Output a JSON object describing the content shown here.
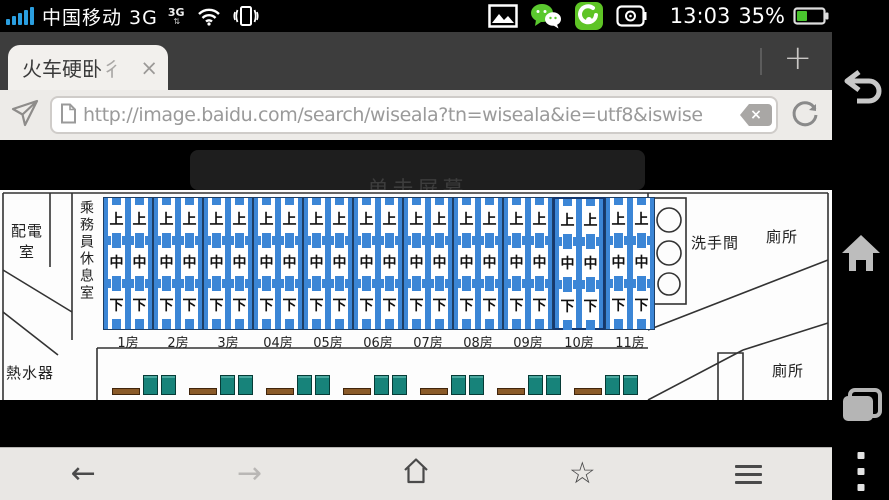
{
  "status_bar": {
    "carrier": "中国移动 3G",
    "network_badge": "3G",
    "network_arrows": "⇅",
    "time": "13:03",
    "battery_percent": "35%",
    "battery_level": 35
  },
  "tab_bar": {
    "tab_title": "火车硬卧",
    "tab_title_clipped": "彳",
    "tab_close": "×",
    "new_tab": "+"
  },
  "url_bar": {
    "url": "http://image.baidu.com/search/wiseala?tn=wiseala&ie=utf8&iswise",
    "clear_label": "×"
  },
  "content": {
    "hint_text": "单击屏幕",
    "diagram": {
      "power_room": "配電室",
      "crew_room": "乘務員休息室",
      "water_heater": "熱水器",
      "washroom": "洗手間",
      "toilet_upper": "廁所",
      "toilet_lower": "廁所",
      "berth_labels": [
        "上",
        "中",
        "下"
      ],
      "compartments": [
        "1房",
        "2房",
        "3房",
        "04房",
        "05房",
        "06房",
        "07房",
        "08房",
        "09房",
        "10房",
        "11房"
      ],
      "highlighted_compartment": "10房",
      "seat_groups": 7,
      "colors": {
        "berth_blue": "#3c86d6",
        "seat_teal": "#17837a",
        "table_brown": "#8a5a28"
      }
    }
  },
  "toolbar": {
    "back": "←",
    "forward": "→",
    "star": "☆"
  }
}
